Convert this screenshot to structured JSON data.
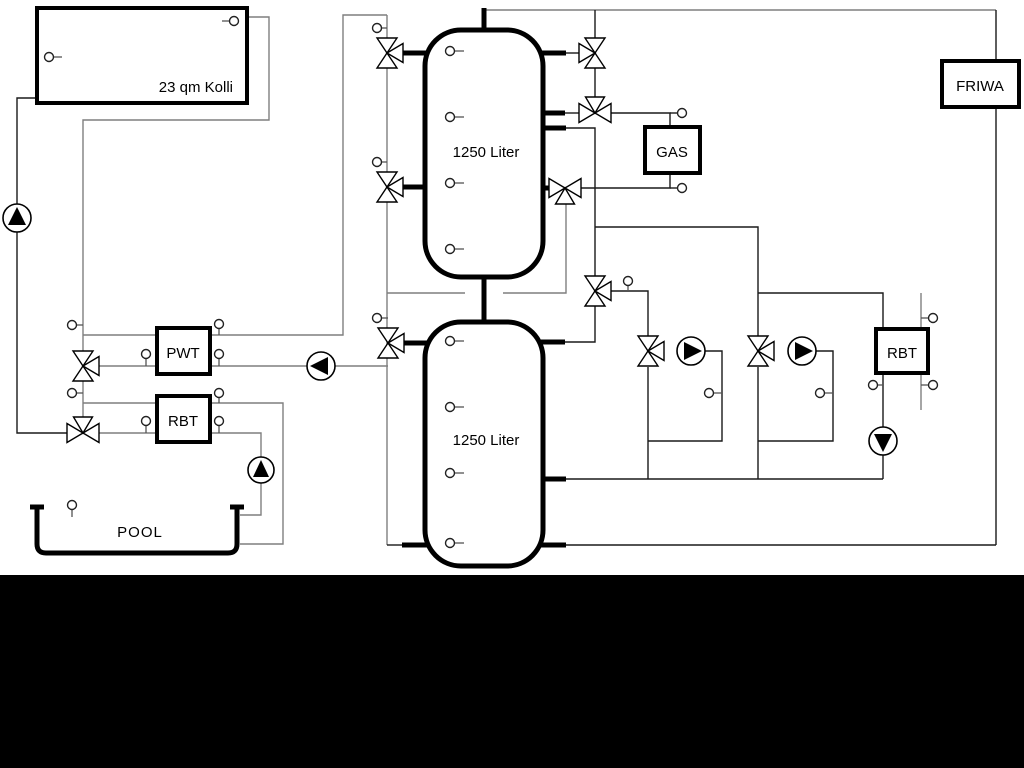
{
  "diagram": {
    "labels": {
      "collector": "23 qm Kolli",
      "tank_top": "1250 Liter",
      "tank_bottom": "1250 Liter",
      "pwt": "PWT",
      "rbt_left": "RBT",
      "gas": "GAS",
      "friwa": "FRIWA",
      "rbt_right": "RBT",
      "pool": "POOL"
    },
    "components": {
      "tanks": [
        "1250 Liter buffer tank (top)",
        "1250 Liter buffer tank (bottom)"
      ],
      "heat_sources": [
        "23 qm Kolli solar collector",
        "GAS boiler"
      ],
      "consumers": [
        "FRIWA fresh water station",
        "POOL",
        "RBT (left)",
        "RBT (right)",
        "PWT plate heat exchanger"
      ],
      "pump_icons": [
        "pump-up-icon",
        "pump-left-icon",
        "pump-up-icon",
        "pump-right-icon",
        "pump-right-icon",
        "pump-down-icon"
      ],
      "valve_icon": "three-way-motor-valve-icon",
      "sensor_icon": "temperature-sensor-icon"
    },
    "colors": {
      "background": "#ffffff",
      "frame": "#000000",
      "pipe_gray": "#7f7f7f",
      "pipe_black": "#1a1a1a"
    }
  }
}
